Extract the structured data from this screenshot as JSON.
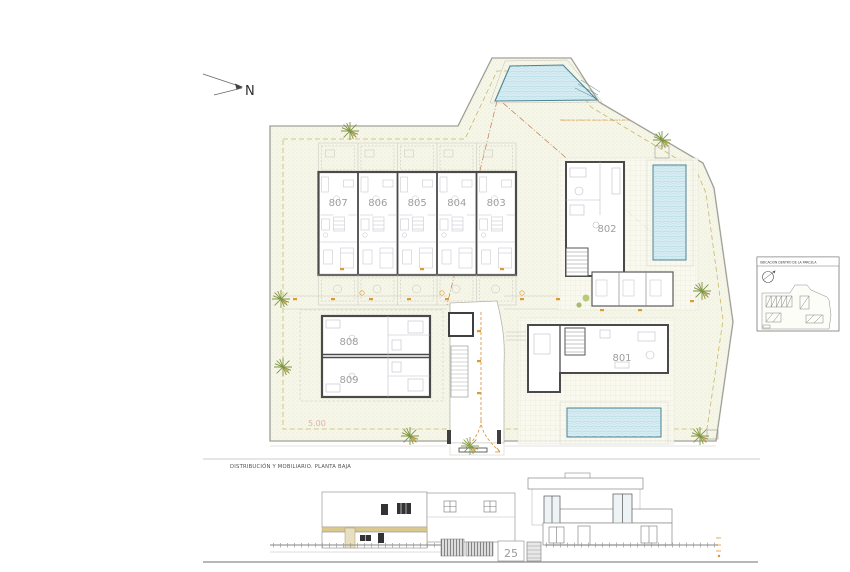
{
  "drawing": {
    "north_label": "N",
    "plan_title": "DISTRIBUCIÓN Y MOBILIARIO. PLANTA BAJA",
    "dimension_5m": "5.00",
    "pool_fence_note": "Vallado de protección del recinto. Altura 1.20 m.",
    "street_number": "25",
    "units": {
      "u801": "801",
      "u802": "802",
      "u803": "803",
      "u804": "804",
      "u805": "805",
      "u806": "806",
      "u807": "807",
      "u808": "808",
      "u809": "809"
    },
    "minimap_title": "UBICACIÓN DENTRO DE LA PARCELA",
    "colors": {
      "site_fill": "#f6f6e9",
      "water": "#d7edf3",
      "water_edge": "#4d8494",
      "wall": "#4a4a4a",
      "annotation_orange": "#d89030",
      "setback_olive": "#c9b86a",
      "facade_band_tan": "#d9c98e",
      "unit_label_gray": "#9e9ea0",
      "dimension_pink": "#dfa3a3",
      "tree_green": "#7e9440"
    }
  }
}
